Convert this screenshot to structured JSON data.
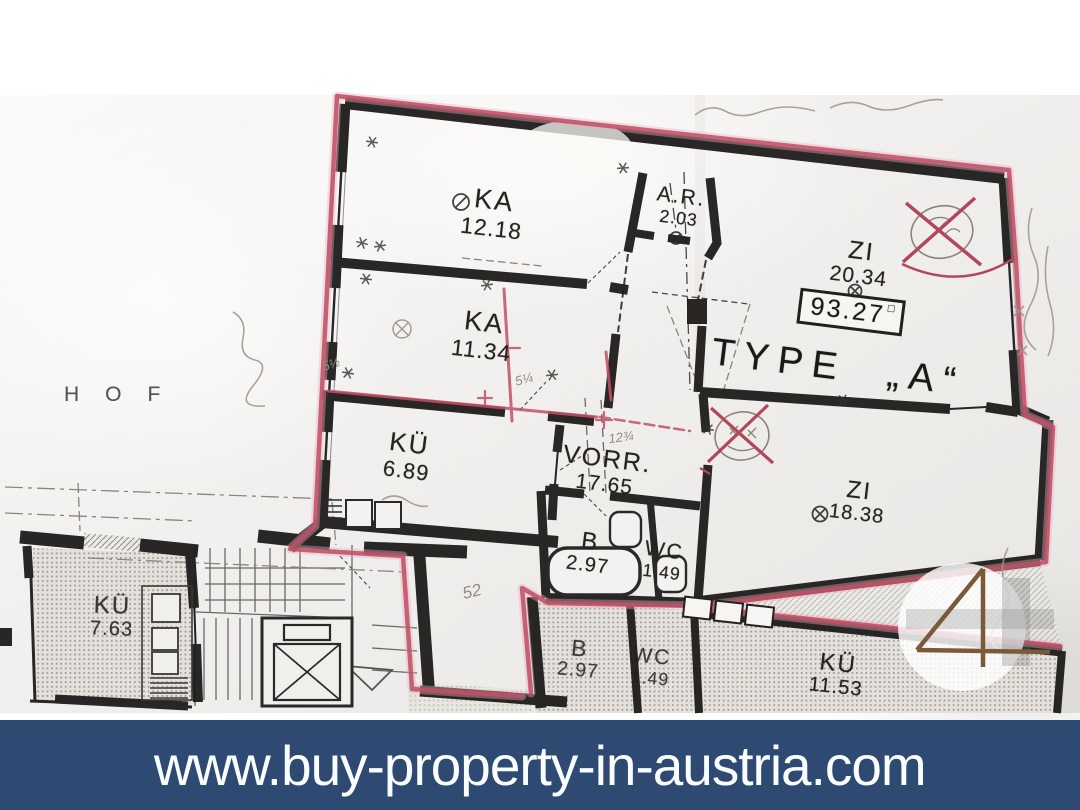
{
  "banner": {
    "url": "www.buy-property-in-austria.com"
  },
  "watermark": {
    "numeral": "4"
  },
  "plan": {
    "courtyard": "HOF",
    "type_label": "TYPE „A“",
    "area_box": {
      "value": "93.27",
      "unit_mark": "□"
    },
    "rooms": [
      {
        "name": "KA",
        "area": "12.18"
      },
      {
        "name": "A.R.",
        "area": "2.03"
      },
      {
        "name": "ZI",
        "area": "20.34"
      },
      {
        "name": "KA",
        "area": "11.34"
      },
      {
        "name": "KÜ",
        "area": "6.89"
      },
      {
        "name": "VORR.",
        "area": "17.65"
      },
      {
        "name": "B",
        "area": "2.97"
      },
      {
        "name": "WC",
        "area": "1.49"
      },
      {
        "name": "ZI",
        "area": "18.38"
      },
      {
        "name": "KÜ",
        "area": "7.63"
      },
      {
        "name": "B",
        "area": "2.97"
      },
      {
        "name": "WC",
        "area": "1.49"
      },
      {
        "name": "KÜ",
        "area": "11.53"
      }
    ],
    "pencil_notes": {
      "note_52": "52",
      "note_12": "12¾",
      "note_5a": "5½",
      "note_5b": "5¼"
    }
  },
  "colors": {
    "banner_bg": "#2e4a73",
    "banner_text": "#fafdff",
    "marker_red": "#c25067",
    "logo_brown": "#7b5a38"
  }
}
